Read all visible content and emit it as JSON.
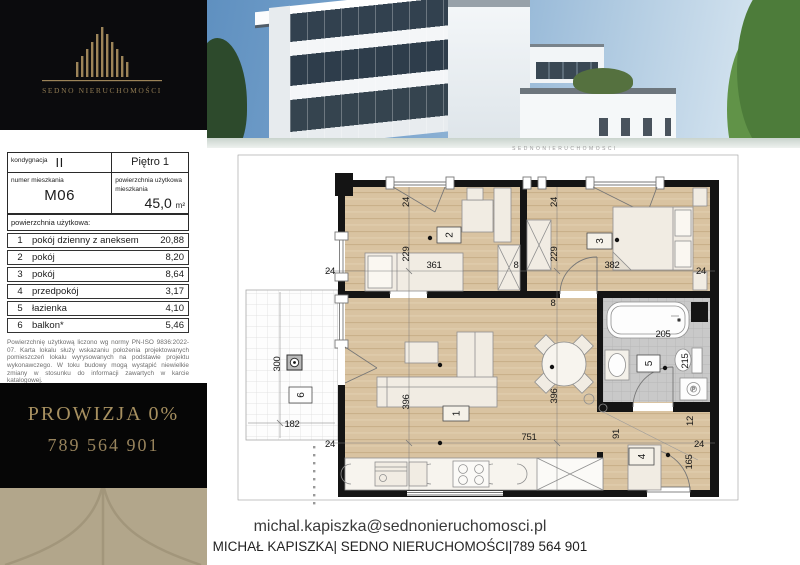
{
  "brand": {
    "name": "SEDNO NIERUCHOMOŚCI"
  },
  "spec": {
    "floor_label": "kondygnacja",
    "floor_value": "II",
    "floor_name": "Piętro 1",
    "unit_label": "numer mieszkania",
    "unit_value": "M06",
    "area_label": "powierzchnia użytkowa mieszkania",
    "area_value": "45,0",
    "area_unit": "m²",
    "rooms_header": "powierzchnia użytkowa:",
    "rooms": [
      {
        "no": "1",
        "name": "pokój dzienny z aneksem",
        "area": "20,88"
      },
      {
        "no": "2",
        "name": "pokój",
        "area": "8,20"
      },
      {
        "no": "3",
        "name": "pokój",
        "area": "8,64"
      },
      {
        "no": "4",
        "name": "przedpokój",
        "area": "3,17"
      },
      {
        "no": "5",
        "name": "łazienka",
        "area": "4,10"
      },
      {
        "no": "6",
        "name": "balkon*",
        "area": "5,46"
      }
    ],
    "disclaimer1": "Powierzchnię użytkową liczono wg normy PN-ISO 9836:2022-07. Karta lokalu służy wskazaniu położenia projektowanych pomieszczeń lokalu wyrysowanych na podstawie projektu wykonawczego. W toku budowy mogą wystąpić niewielkie zmiany w stosunku do informacji zawartych w karcie katalogowej.",
    "disclaimer2": "*Powierzchnia tarasów i balkonów nie wlicza się do powierzchni użytkowej."
  },
  "promo": {
    "line1": "PROWIZJA 0%",
    "line2": "789 564 901"
  },
  "contact": {
    "email": "michal.kapiszka@sednonieruchomosci.pl",
    "line": "MICHAŁ KAPISZKA| SEDNO NIERUCHOMOŚCI|789 564 901"
  },
  "plan": {
    "watermark": "SEDNONIERUCHOMOSCI",
    "washer_label": "P",
    "rooms": {
      "r1": "1",
      "r2": "2",
      "r3": "3",
      "r4": "4",
      "r5": "5",
      "r6": "6"
    },
    "dims": {
      "d24_r2top": "24",
      "d229_r2": "229",
      "d361": "361",
      "d8_mid": "8",
      "d8_low": "8",
      "d24_r3top": "24",
      "d229_r3": "229",
      "d382": "382",
      "d24_right": "24",
      "d24_left": "24",
      "d396_a": "396",
      "d396_b": "396",
      "d751": "751",
      "d24_bottomleft": "24",
      "d24_hall": "24",
      "d205": "205",
      "d215": "215",
      "d91": "91",
      "d12": "12",
      "d165": "165",
      "d300": "300",
      "d182": "182"
    }
  }
}
